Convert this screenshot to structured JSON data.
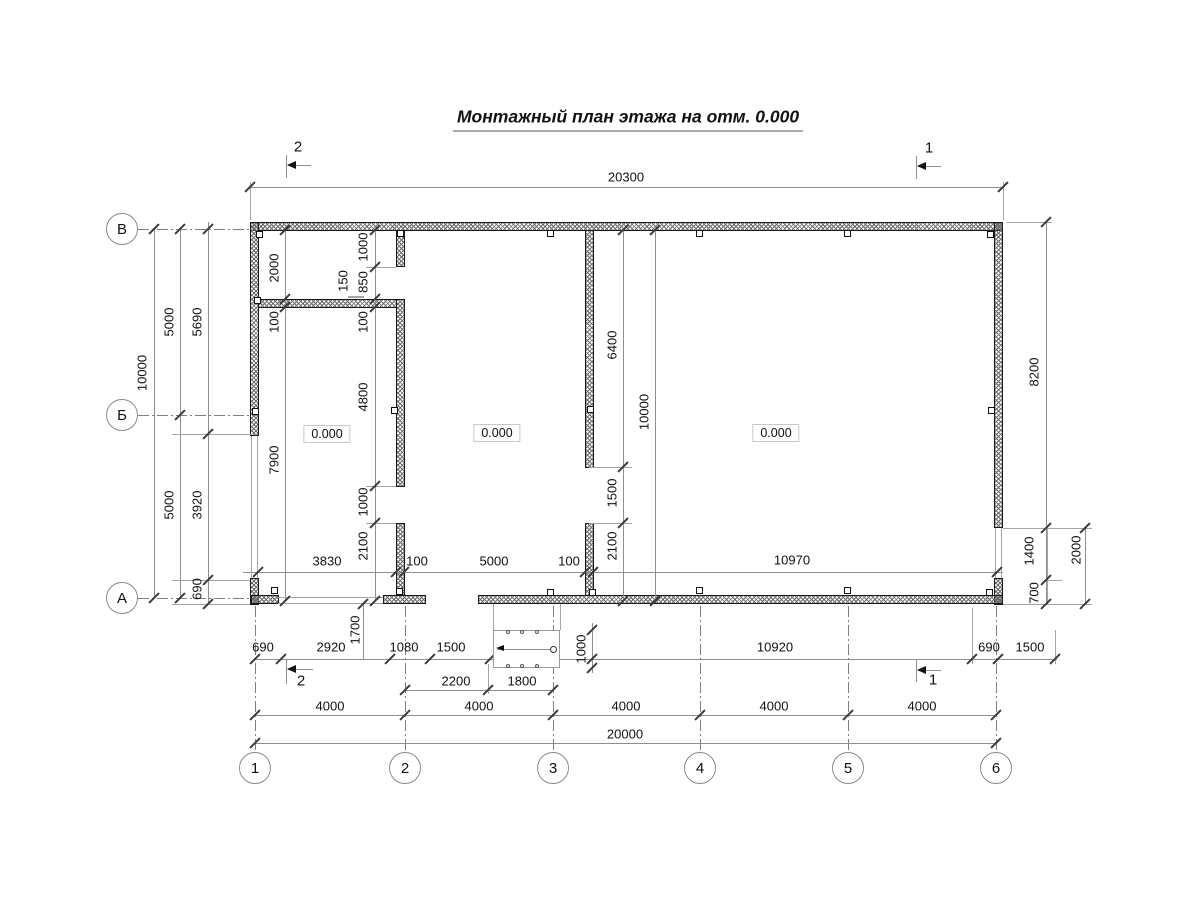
{
  "title": "Монтажный план этажа на отм. 0.000",
  "axes": {
    "rows": [
      "В",
      "Б",
      "А"
    ],
    "columns": [
      "1",
      "2",
      "3",
      "4",
      "5",
      "6"
    ]
  },
  "section_markers": [
    "2",
    "1",
    "2",
    "1"
  ],
  "elevation_labels": [
    "0.000",
    "0.000",
    "0.000"
  ],
  "ramp": {
    "length": "2500",
    "slope": "1:12",
    "depth": "1000"
  },
  "dim_labels": [
    {
      "t": "20300",
      "x": 626,
      "y": 177,
      "r": 0
    },
    {
      "t": "3830",
      "x": 327,
      "y": 561,
      "r": 0
    },
    {
      "t": "100",
      "x": 417,
      "y": 561,
      "r": 0
    },
    {
      "t": "5000",
      "x": 494,
      "y": 561,
      "r": 0
    },
    {
      "t": "100",
      "x": 569,
      "y": 561,
      "r": 0
    },
    {
      "t": "10970",
      "x": 792,
      "y": 560,
      "r": 0
    },
    {
      "t": "690",
      "x": 263,
      "y": 647,
      "r": 0
    },
    {
      "t": "2920",
      "x": 331,
      "y": 647,
      "r": 0
    },
    {
      "t": "1080",
      "x": 404,
      "y": 647,
      "r": 0
    },
    {
      "t": "1500",
      "x": 451,
      "y": 647,
      "r": 0
    },
    {
      "t": "2500",
      "x": 527,
      "y": 641,
      "r": 0
    },
    {
      "t": "1:12",
      "x": 527,
      "y": 657,
      "r": 0,
      "s": 1
    },
    {
      "t": "10920",
      "x": 775,
      "y": 647,
      "r": 0
    },
    {
      "t": "690",
      "x": 989,
      "y": 647,
      "r": 0
    },
    {
      "t": "1500",
      "x": 1030,
      "y": 647,
      "r": 0
    },
    {
      "t": "2200",
      "x": 456,
      "y": 681,
      "r": 0
    },
    {
      "t": "1800",
      "x": 522,
      "y": 681,
      "r": 0
    },
    {
      "t": "4000",
      "x": 330,
      "y": 706,
      "r": 0
    },
    {
      "t": "4000",
      "x": 479,
      "y": 706,
      "r": 0
    },
    {
      "t": "4000",
      "x": 626,
      "y": 706,
      "r": 0
    },
    {
      "t": "4000",
      "x": 774,
      "y": 706,
      "r": 0
    },
    {
      "t": "4000",
      "x": 922,
      "y": 706,
      "r": 0
    },
    {
      "t": "20000",
      "x": 625,
      "y": 734,
      "r": 0
    },
    {
      "t": "10000",
      "x": 142,
      "y": 373,
      "r": 1
    },
    {
      "t": "5000",
      "x": 169,
      "y": 322,
      "r": 1
    },
    {
      "t": "5000",
      "x": 169,
      "y": 505,
      "r": 1
    },
    {
      "t": "5690",
      "x": 197,
      "y": 322,
      "r": 1
    },
    {
      "t": "3920",
      "x": 197,
      "y": 505,
      "r": 1
    },
    {
      "t": "690",
      "x": 197,
      "y": 589,
      "r": 1
    },
    {
      "t": "2000",
      "x": 274,
      "y": 268,
      "r": 1
    },
    {
      "t": "100",
      "x": 274,
      "y": 322,
      "r": 1
    },
    {
      "t": "7900",
      "x": 274,
      "y": 460,
      "r": 1
    },
    {
      "t": "1000",
      "x": 363,
      "y": 247,
      "r": 1
    },
    {
      "t": "850",
      "x": 363,
      "y": 282,
      "r": 1
    },
    {
      "t": "150",
      "x": 343,
      "y": 281,
      "r": 1
    },
    {
      "t": "100",
      "x": 363,
      "y": 322,
      "r": 1
    },
    {
      "t": "4800",
      "x": 363,
      "y": 397,
      "r": 1
    },
    {
      "t": "1000",
      "x": 363,
      "y": 502,
      "r": 1
    },
    {
      "t": "2100",
      "x": 363,
      "y": 546,
      "r": 1
    },
    {
      "t": "1700",
      "x": 355,
      "y": 630,
      "r": 1
    },
    {
      "t": "6400",
      "x": 612,
      "y": 345,
      "r": 1
    },
    {
      "t": "1500",
      "x": 612,
      "y": 493,
      "r": 1
    },
    {
      "t": "2100",
      "x": 612,
      "y": 546,
      "r": 1
    },
    {
      "t": "10000",
      "x": 644,
      "y": 412,
      "r": 1
    },
    {
      "t": "1000",
      "x": 581,
      "y": 649,
      "r": 1
    },
    {
      "t": "8200",
      "x": 1034,
      "y": 372,
      "r": 1
    },
    {
      "t": "1400",
      "x": 1029,
      "y": 551,
      "r": 1
    },
    {
      "t": "700",
      "x": 1034,
      "y": 593,
      "r": 1
    },
    {
      "t": "2000",
      "x": 1076,
      "y": 550,
      "r": 1
    }
  ]
}
